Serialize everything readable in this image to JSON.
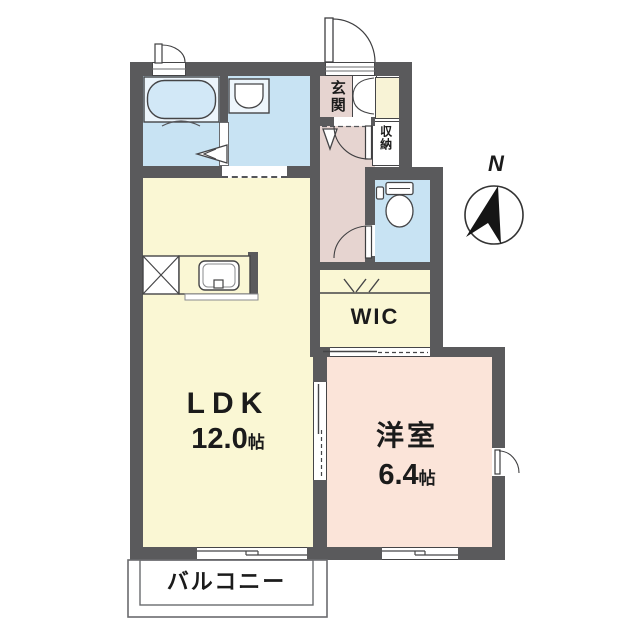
{
  "type": "apartment-floor-plan",
  "compass": {
    "label": "N"
  },
  "rooms": {
    "ldk": {
      "name": "LDK",
      "size_value": "12.0",
      "size_unit": "帖"
    },
    "western_room": {
      "name": "洋室",
      "size_value": "6.4",
      "size_unit": "帖"
    },
    "wic": {
      "label": "WIC"
    },
    "entrance": {
      "label": "玄関"
    },
    "storage": {
      "label": "収納"
    },
    "balcony": {
      "label": "バルコニー"
    }
  },
  "colors": {
    "wall": "#5a5a5c",
    "wet_rooms_blue": "#c8e3f3",
    "ldk_yellow": "#faf7d4",
    "entrance_pink": "#e6d4d0",
    "western_room_pink": "#fbe4d9",
    "closet_yellow": "#f8f3d6",
    "text": "#1b1b1b"
  }
}
